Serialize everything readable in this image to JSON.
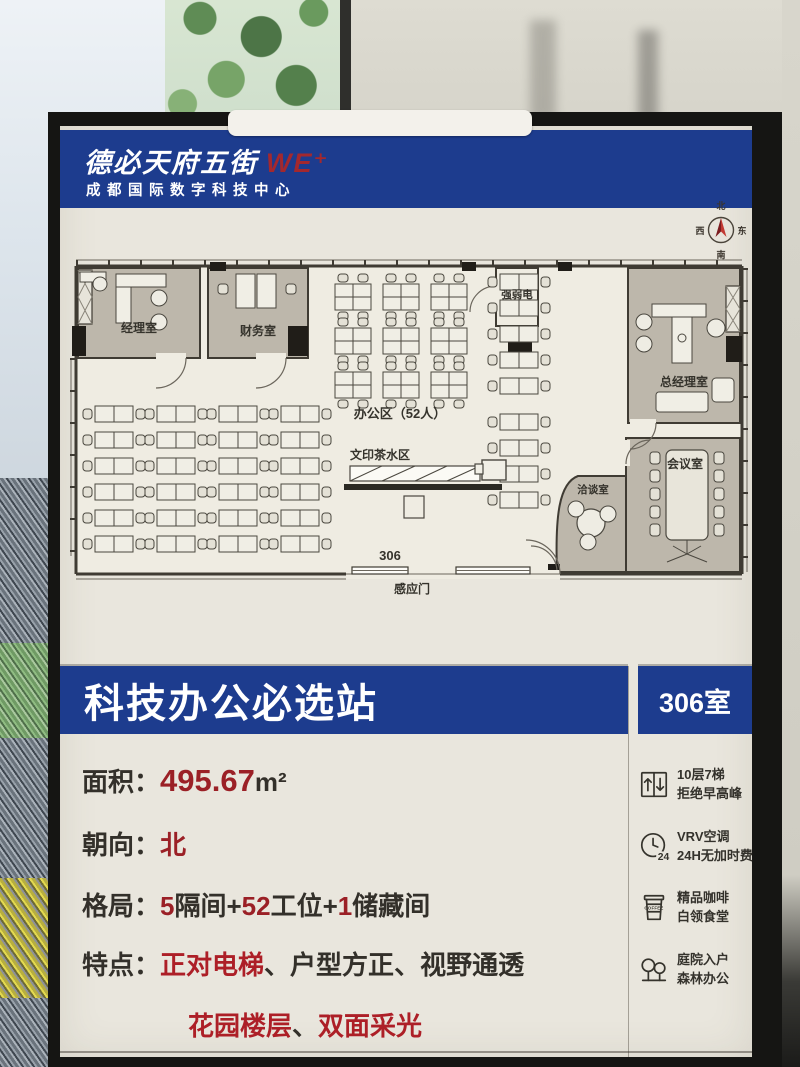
{
  "brand": {
    "name": "德必天府五街",
    "logo": "WE⁺",
    "subtitle": "成都国际数字科技中心"
  },
  "plan": {
    "compass": {
      "north": "北",
      "east": "东",
      "south": "南",
      "west": "西"
    },
    "rooms": {
      "manager": "经理室",
      "finance": "财务室",
      "utility": "强弱电",
      "gm_office": "总经理室",
      "office_area": "办公区（52人）",
      "print_tea": "文印茶水区",
      "negotiation": "洽谈室",
      "conference": "会议室"
    },
    "room_number": "306",
    "entrance_door": "感应门"
  },
  "titlebar": {
    "title": "科技办公必选站",
    "room": "306室"
  },
  "specs": {
    "area": {
      "label": "面积：",
      "value": "495.67",
      "unit": "m²"
    },
    "orientation": {
      "label": "朝向：",
      "value": "北"
    },
    "layout": {
      "label": "格局：",
      "p0": "5",
      "p1": "隔间+",
      "p2": "52",
      "p3": "工位+",
      "p4": "1",
      "p5": "储藏间"
    },
    "features": {
      "label": "特点：",
      "f1": "正对电梯",
      "s1": "、",
      "f2": "户型方正",
      "s2": "、",
      "f3": "视野通透",
      "f4": "花园楼层",
      "s3": "、",
      "f5": "双面采光"
    }
  },
  "amenities": {
    "items": [
      {
        "line1": "10层7梯",
        "line2": "拒绝早高峰"
      },
      {
        "line1": "VRV空调",
        "line2": "24H无加时费"
      },
      {
        "line1": "精品咖啡",
        "line2": "白领食堂"
      },
      {
        "line1": "庭院入户",
        "line2": "森林办公"
      }
    ],
    "clock_text": "24",
    "coffee_text": "COFFEE"
  },
  "colors": {
    "brand_blue": "#1d3c8e",
    "accent_red": "#9b2026",
    "poster_cream": "#e9e6dd"
  }
}
